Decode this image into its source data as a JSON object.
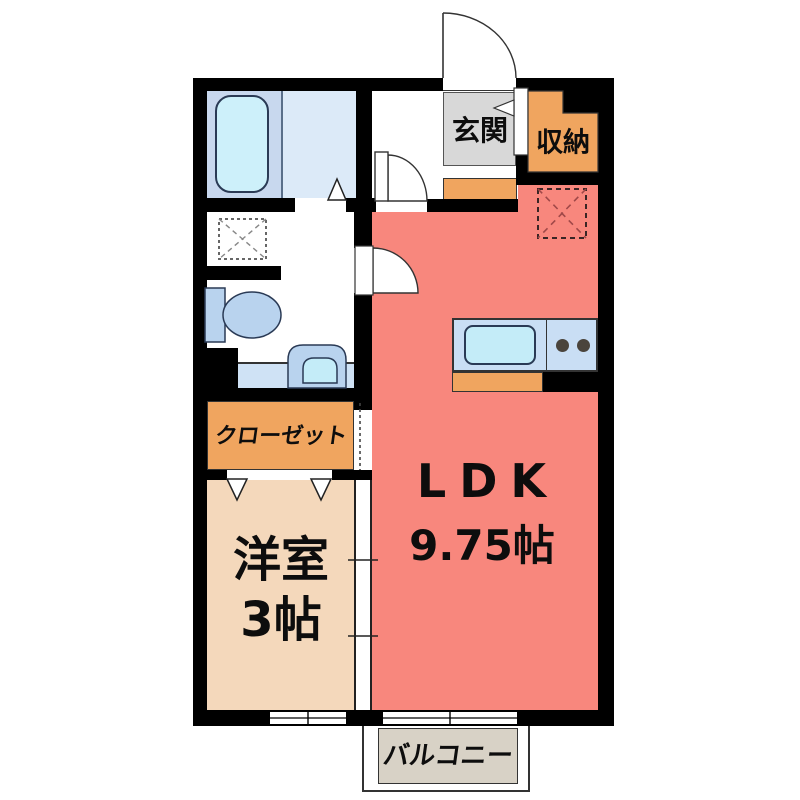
{
  "plan": {
    "type": "floor-plan",
    "rooms": {
      "genkan": {
        "label": "玄関"
      },
      "storage": {
        "label": "収納"
      },
      "closet": {
        "label": "クローゼット"
      },
      "western_room": {
        "label": "洋室",
        "size": "3帖"
      },
      "ldk": {
        "label": "LDK",
        "size": "9.75帖"
      },
      "balcony": {
        "label": "バルコニー"
      }
    },
    "fixtures": [
      "bathtub-icon",
      "kitchen-sink-icon",
      "stove-burners-icon",
      "toilet-icon",
      "washbasin-icon",
      "washing-machine-space-icon",
      "refrigerator-space-icon",
      "entrance-door-arc",
      "hall-door-arc",
      "washroom-door-arc",
      "folding-door-triangles",
      "sliding-door-symbol",
      "window-symbols"
    ],
    "colors": {
      "wall": "#000000",
      "ldk_fill": "#f8877d",
      "western_fill": "#f4d8bb",
      "orange_fill": "#f0a55f",
      "genkan_gray": "#d8d8d8",
      "bath_left": "#c8d8ee",
      "bath_right": "#dceaf8",
      "tub_fill": "#cdf0fa",
      "fixture_blue": "#b9d3ee",
      "fixture_cyan": "#c4ecf8",
      "counter_blue": "#c9def4",
      "basin_counter": "#cfe2f5",
      "balcony_fill": "#d8d2c6",
      "burner": "#4a443c",
      "refrigerator_x": "#a04848",
      "label_text": "#0d0d0d"
    }
  }
}
